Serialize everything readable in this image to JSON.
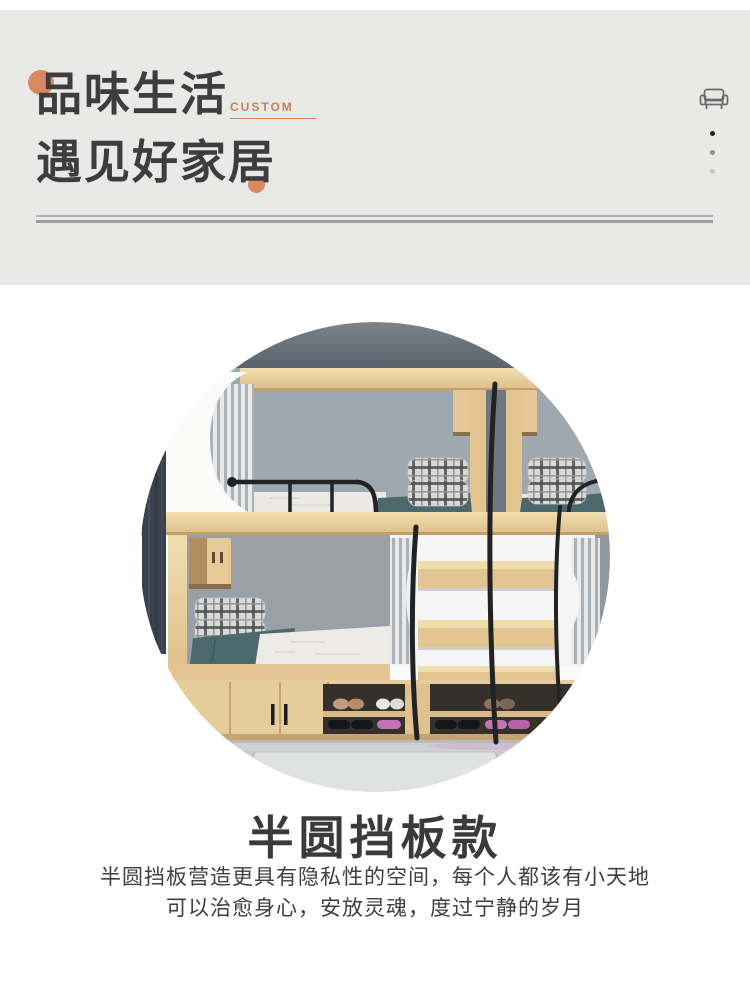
{
  "header": {
    "title_line1": "品味生活",
    "custom_label": "CUSTOM",
    "title_line2": "遇见好家居",
    "background": "#e9e9e7",
    "text_color": "#3d3d3d",
    "accent_color": "#d9895f",
    "sofa_icon": "sofa-outline-icon",
    "dot_colors": [
      "#1f1f1f",
      "#909090",
      "#c6c6c6"
    ]
  },
  "hero": {
    "photo": "bunk-bed-room-photo",
    "palette": {
      "wall_dark": "#5d656d",
      "wall_light": "#9fa7af",
      "wood": "#e6cb9b",
      "bedding_teal": "#4d686b",
      "mattress_white": "#ebe9e4",
      "metal_black": "#202225",
      "floor_marble": "#ced1d2",
      "slipper_pink": "#c273b5"
    }
  },
  "section": {
    "heading": "半圆挡板款",
    "body_line1": "半圆挡板营造更具有隐私性的空间，每个人都该有小天地",
    "body_line2": "可以治愈身心，安放灵魂，度过宁静的岁月"
  }
}
